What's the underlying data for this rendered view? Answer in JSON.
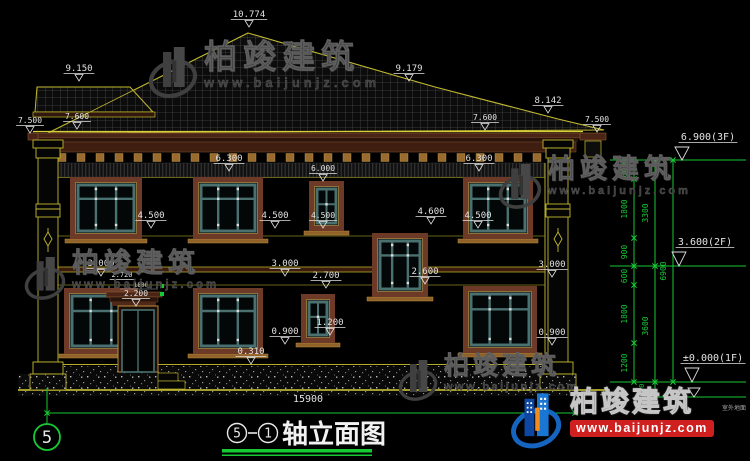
{
  "drawing": {
    "type": "architectural-elevation",
    "overall_width_dim": "15900",
    "floor_levels": [
      "6.900(3F)",
      "3.600(2F)",
      "±0.000(1F)"
    ],
    "ground_note": "室外地面"
  },
  "title_block": {
    "axis": "5",
    "ref": "1",
    "name": "轴立面图"
  },
  "axis_bubble": "5",
  "watermark": {
    "brand": "柏竣建筑",
    "url": "www.baijunjz.com"
  },
  "brand": {
    "name": "柏竣建筑",
    "url": "www.baijunjz.com",
    "accent_blue": "#1565c0",
    "accent_dark_blue": "#0d47a1",
    "accent_orange": "#f28c1b",
    "url_bg": "#cf1f1f"
  },
  "colors": {
    "line_yellow": "#c2b92e",
    "dim_white": "#e2e2e2",
    "cad_green": "#17c935",
    "frame_brown": "#6e3a28",
    "sash_teal": "#4a7070"
  },
  "annotations": [
    {
      "t": "10.774",
      "x": 249,
      "y": 17
    },
    {
      "t": "9.150",
      "x": 79,
      "y": 71
    },
    {
      "t": "9.179",
      "x": 409,
      "y": 71
    },
    {
      "t": "8.142",
      "x": 548,
      "y": 103
    },
    {
      "t": "7.600",
      "x": 77,
      "y": 119,
      "s": 8
    },
    {
      "t": "7.600",
      "x": 485,
      "y": 120,
      "s": 8
    },
    {
      "t": "7.500",
      "x": 30,
      "y": 123,
      "s": 8
    },
    {
      "t": "7.500",
      "x": 597,
      "y": 122,
      "s": 8
    },
    {
      "t": "6.300",
      "x": 229,
      "y": 161
    },
    {
      "t": "6.300",
      "x": 479,
      "y": 161
    },
    {
      "t": "6.000",
      "x": 323,
      "y": 171,
      "s": 8
    },
    {
      "t": "4.500",
      "x": 151,
      "y": 218
    },
    {
      "t": "4.500",
      "x": 275,
      "y": 218
    },
    {
      "t": "4.500",
      "x": 323,
      "y": 218,
      "s": 8
    },
    {
      "t": "4.600",
      "x": 431,
      "y": 214
    },
    {
      "t": "4.500",
      "x": 478,
      "y": 218
    },
    {
      "t": "3.000",
      "x": 101,
      "y": 266
    },
    {
      "t": "3.000",
      "x": 285,
      "y": 266
    },
    {
      "t": "3.000",
      "x": 552,
      "y": 267
    },
    {
      "t": "2.720",
      "x": 122,
      "y": 277,
      "s": 7,
      "m": "u"
    },
    {
      "t": "1800",
      "x": 141,
      "y": 287,
      "s": 6,
      "m": "n"
    },
    {
      "t": "2.200",
      "x": 136,
      "y": 296,
      "s": 8
    },
    {
      "t": "2.700",
      "x": 326,
      "y": 278
    },
    {
      "t": "2.600",
      "x": 425,
      "y": 274
    },
    {
      "t": "1.200",
      "x": 330,
      "y": 325
    },
    {
      "t": "0.900",
      "x": 285,
      "y": 334
    },
    {
      "t": "0.900",
      "x": 552,
      "y": 335
    },
    {
      "t": "0.310",
      "x": 251,
      "y": 354
    },
    {
      "t": "15900",
      "x": 308,
      "y": 402,
      "s": 10,
      "m": "n"
    },
    {
      "t": "6.900(3F)",
      "x": 708,
      "y": 140,
      "s": 10,
      "m": "u"
    },
    {
      "t": "3.600(2F)",
      "x": 705,
      "y": 245,
      "s": 10,
      "m": "u"
    },
    {
      "t": "±0.000(1F)",
      "x": 713,
      "y": 361,
      "s": 10,
      "m": "u"
    },
    {
      "t": "室外地面",
      "x": 734,
      "y": 410,
      "s": 6,
      "m": "n",
      "c": "#a8a8a8"
    },
    {
      "t": "600",
      "x": 627,
      "y": 170,
      "r": -90,
      "s": 8,
      "m": "n",
      "c": "#17c935"
    },
    {
      "t": "1800",
      "x": 627,
      "y": 209,
      "r": -90,
      "s": 8,
      "m": "n",
      "c": "#17c935"
    },
    {
      "t": "900",
      "x": 627,
      "y": 252,
      "r": -90,
      "s": 8,
      "m": "n",
      "c": "#17c935"
    },
    {
      "t": "600",
      "x": 627,
      "y": 276,
      "r": -90,
      "s": 8,
      "m": "n",
      "c": "#17c935"
    },
    {
      "t": "1800",
      "x": 627,
      "y": 314,
      "r": -90,
      "s": 8,
      "m": "n",
      "c": "#17c935"
    },
    {
      "t": "1200",
      "x": 627,
      "y": 363,
      "r": -90,
      "s": 8,
      "m": "n",
      "c": "#17c935"
    },
    {
      "t": "450",
      "x": 644,
      "y": 390,
      "r": -90,
      "s": 7,
      "m": "n",
      "c": "#17c935"
    },
    {
      "t": "3300",
      "x": 648,
      "y": 213,
      "r": -90,
      "s": 8,
      "m": "n",
      "c": "#17c935"
    },
    {
      "t": "3600",
      "x": 648,
      "y": 326,
      "r": -90,
      "s": 8,
      "m": "n",
      "c": "#17c935"
    },
    {
      "t": "6900",
      "x": 666,
      "y": 271,
      "r": -90,
      "s": 8,
      "m": "n",
      "c": "#17c935"
    }
  ]
}
